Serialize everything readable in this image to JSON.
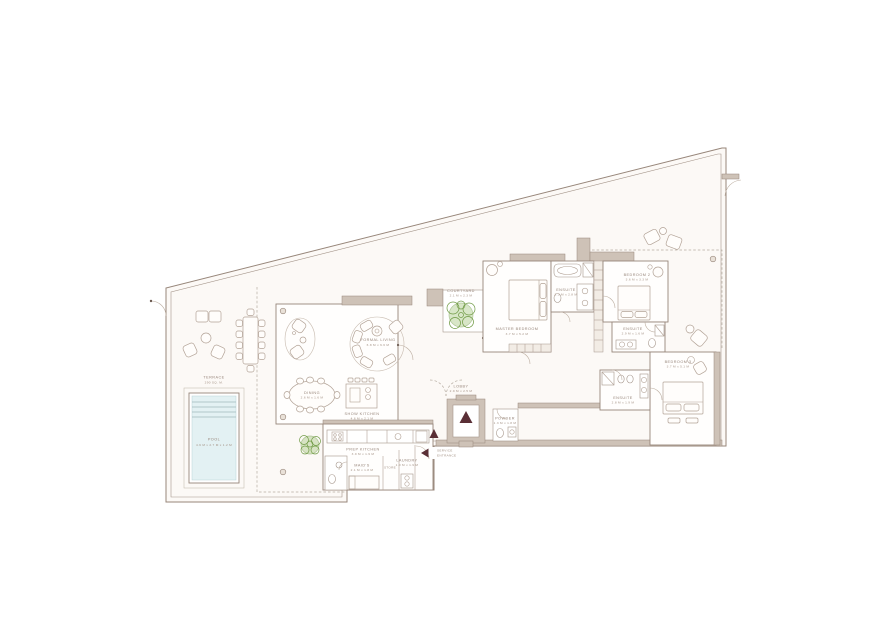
{
  "colors": {
    "wall_fill": "#cec2b7",
    "wall_line": "#97867a",
    "floor": "#fcf9f6",
    "pool_water": "#e3f1f3",
    "plant_fill": "#b9d29b",
    "arrow": "#5a2f36",
    "text": "#97857a"
  },
  "labels": {
    "terrace": {
      "name": "TERRACE",
      "dims": "290 SQ. M."
    },
    "pool": {
      "name": "POOL",
      "dims": "4.9 M x 2.7 M x 1.2 M"
    },
    "formal_living": {
      "name": "FORMAL LIVING",
      "dims": "6.8 M x 6.6 M"
    },
    "dining": {
      "name": "DINING",
      "dims": "2.6 M x 1.6 M"
    },
    "show_kitchen": {
      "name": "SHOW KITCHEN",
      "dims": "4.6 M x 2.1 M"
    },
    "courtyard": {
      "name": "COURTYARD",
      "dims": "2.1 M x 2.3 M"
    },
    "prep_kitchen": {
      "name": "PREP KITCHEN",
      "dims": "3.9 M x 1.9 M"
    },
    "maids_room": {
      "name": "MAID'S",
      "dims": "2.1 M x 1.8 M"
    },
    "store": {
      "name": "STORE"
    },
    "laundry": {
      "name": "LAUNDRY",
      "dims": "1.0 M x 1.9 M"
    },
    "lobby": {
      "name": "LOBBY",
      "dims": "2.9 M x 2.5 M"
    },
    "powder": {
      "name": "POWDER",
      "dims": "1.3 M x 1.8 M"
    },
    "service_entrance": {
      "line1": "SERVICE",
      "line2": "ENTRANCE"
    },
    "master_bedroom": {
      "name": "MASTER BEDROOM",
      "dims": "3.7 M x 5.2 M"
    },
    "master_ensuite": {
      "name": "ENSUITE",
      "dims": "2.3 M x 2.8 M"
    },
    "bedroom_2": {
      "name": "BEDROOM 2",
      "dims": "3.6 M x 3.3 M"
    },
    "bedroom_2_ensuite": {
      "name": "ENSUITE",
      "dims": "2.9 M x 1.6 M"
    },
    "bedroom_3": {
      "name": "BEDROOM 3",
      "dims": "3.7 M x 5.1 M"
    },
    "bedroom_3_ensuite": {
      "name": "ENSUITE",
      "dims": "2.8 M x 1.9 M"
    }
  }
}
